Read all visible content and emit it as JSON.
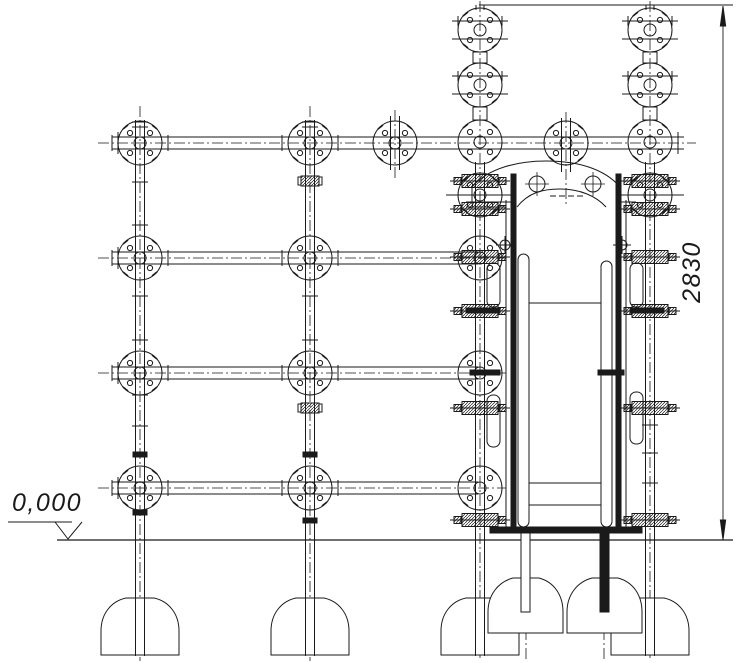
{
  "drawing": {
    "type": "engineering-elevation-drawing",
    "background_color": "#ffffff",
    "line_color": "#1a1a1a",
    "annotations": {
      "elevation_marker": "0,000",
      "overall_height_dimension": "2830"
    }
  }
}
